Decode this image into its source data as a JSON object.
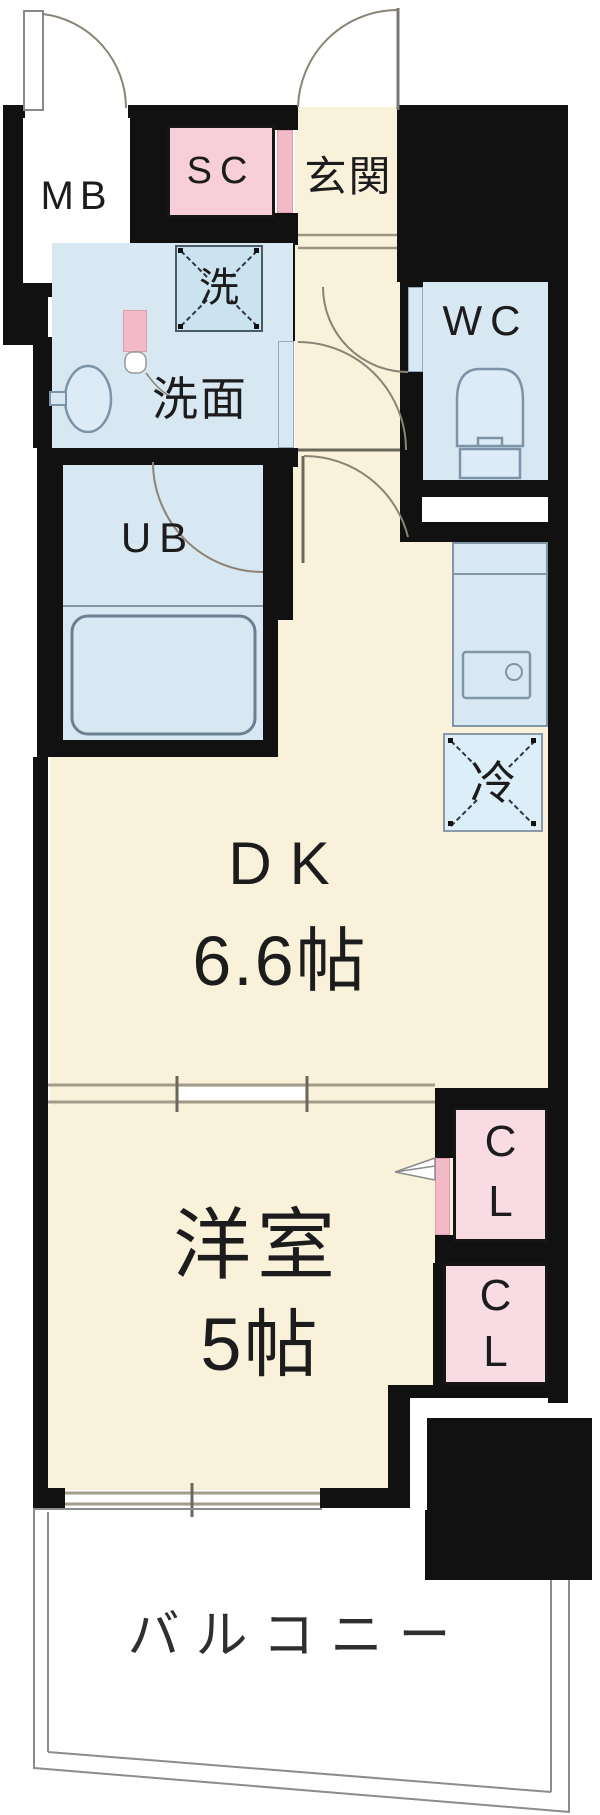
{
  "floorplan": {
    "rooms": {
      "mb": {
        "label": "MB"
      },
      "sc": {
        "label": "SC"
      },
      "genkan": {
        "label": "玄関"
      },
      "laundry": {
        "label": "洗"
      },
      "washroom": {
        "label": "洗面"
      },
      "wc": {
        "label": "WC"
      },
      "ub": {
        "label": "UB"
      },
      "fridge": {
        "label": "冷"
      },
      "dk": {
        "label": "DK",
        "size": "6.6帖"
      },
      "western_room": {
        "label": "洋室",
        "size": "5帖"
      },
      "closet1": {
        "line1": "C",
        "line2": "L"
      },
      "closet2": {
        "line1": "C",
        "line2": "L"
      },
      "balcony": {
        "label": "バルコニー"
      }
    },
    "colors": {
      "wall": "#111111",
      "floor_cream": "#FAF1DB",
      "wet_room_blue": "#D8E8F3",
      "closet_pink": "#F8CFD9",
      "closet_pink_light": "#F9DCE3",
      "door_pink": "#F3B9C6",
      "door_arc": "#8B8375",
      "fixture_stroke": "#7D93A8",
      "track_line": "#9B9383",
      "balcony_line": "#8C8C8C"
    }
  }
}
